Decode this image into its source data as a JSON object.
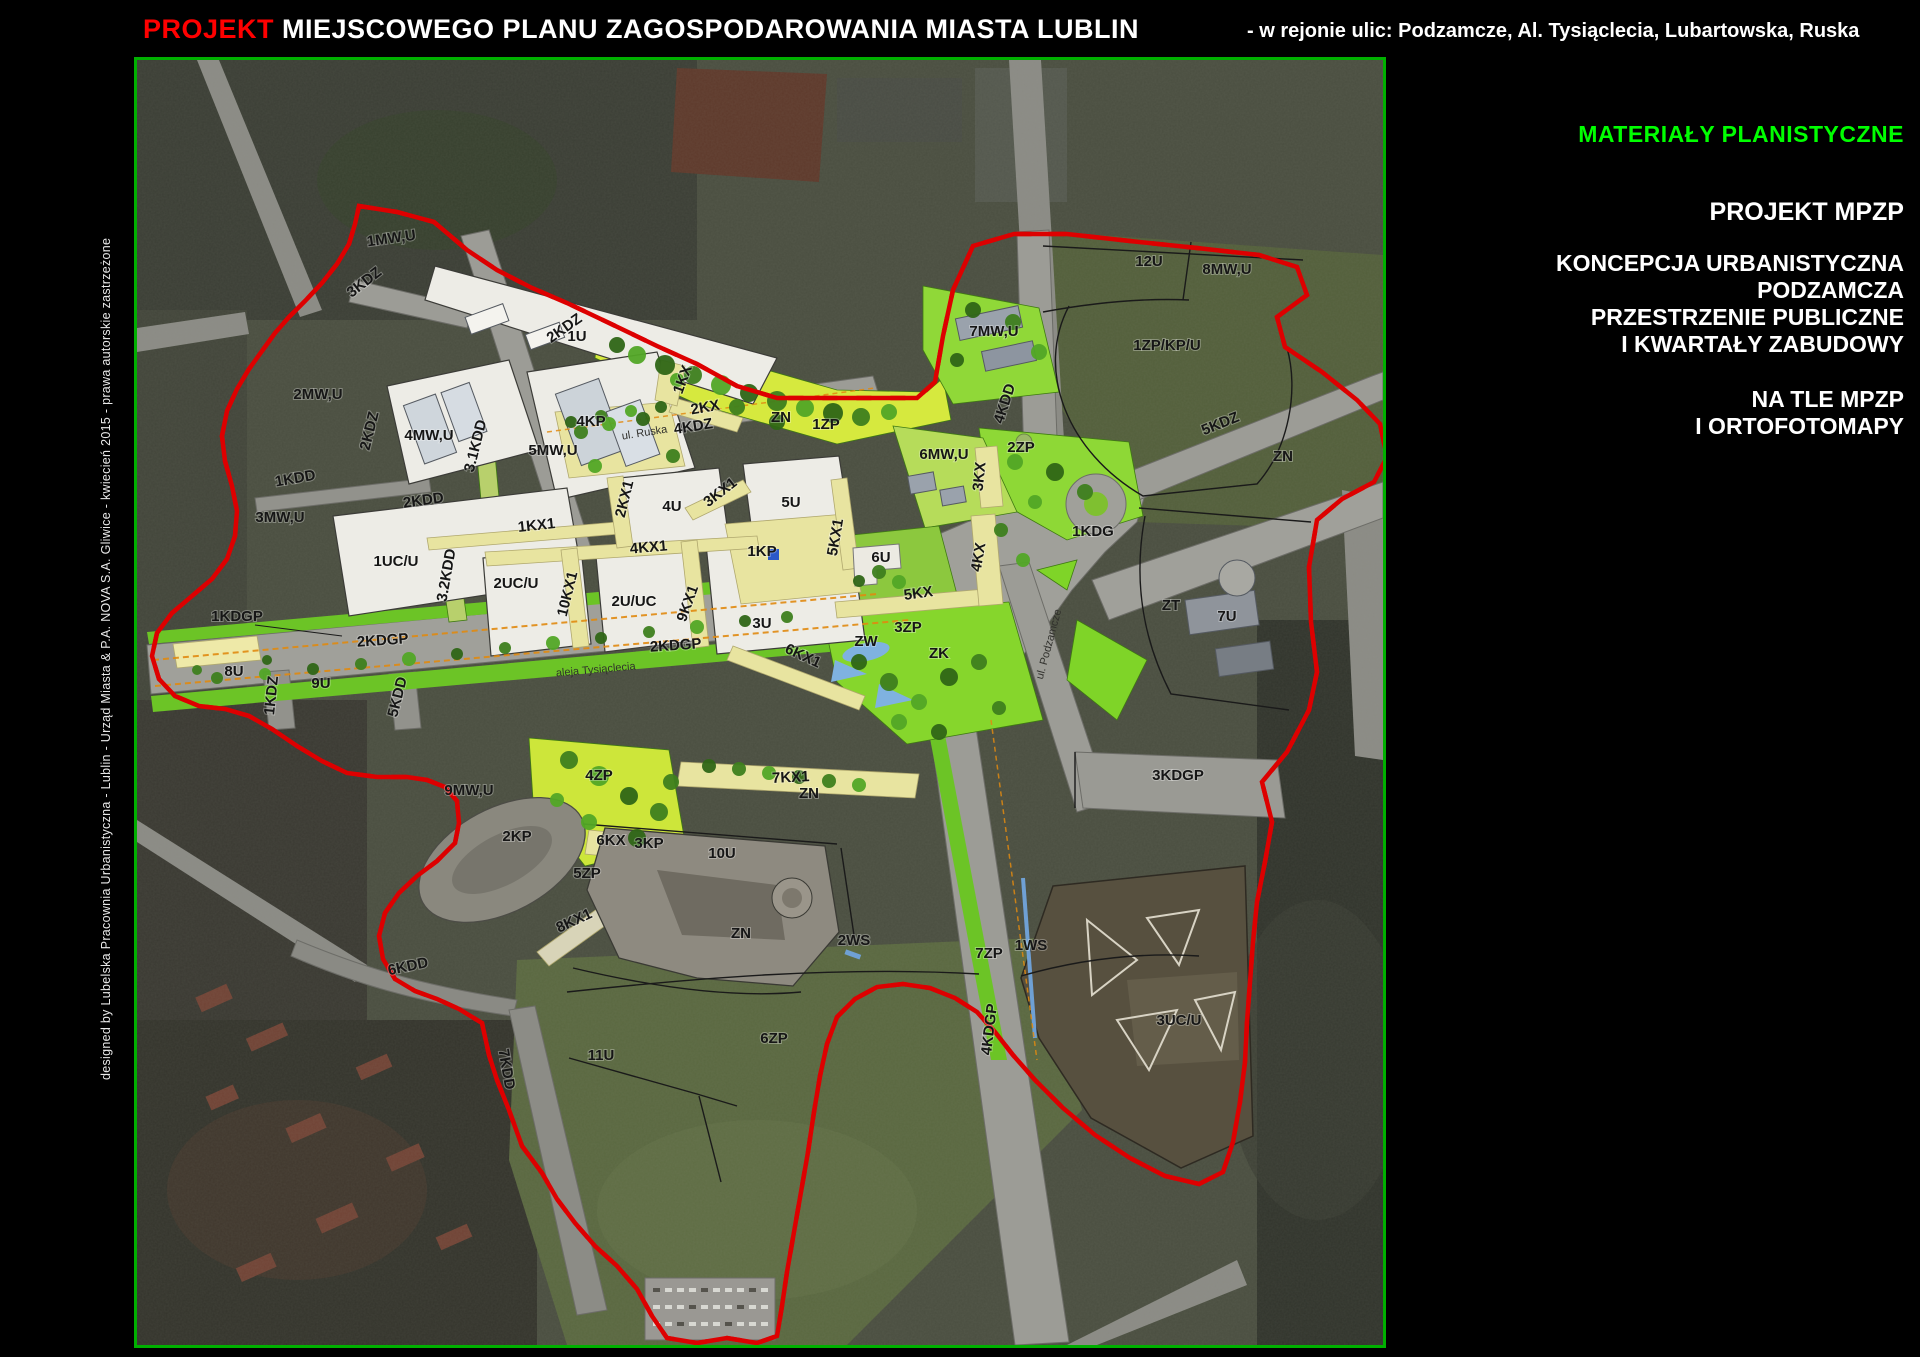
{
  "header": {
    "projekt": "PROJEKT",
    "title": " MIEJSCOWEGO PLANU ZAGOSPODAROWANIA MIASTA LUBLIN",
    "subtitle": "- w rejonie ulic: Podzamcze, Al. Tysiąclecia, Lubartowska, Ruska"
  },
  "credit": "designed by Lubelska Pracownia Urbanistyczna - Lublin - Urząd Miasta & P.A. NOVA S.A. Gliwice - kwiecień 2015 - prawa autorskie zastrzeżone",
  "panel": {
    "heading": "MATERIAŁY PLANISTYCZNE",
    "line1": "PROJEKT MPZP",
    "line2": "KONCEPCJA URBANISTYCZNA",
    "line3": "PODZAMCZA",
    "line4": "PRZESTRZENIE PUBLICZNE",
    "line5": "I KWARTAŁY ZABUDOWY",
    "line6": "NA TLE MPZP",
    "line7": "I ORTOFOTOMAPY"
  },
  "colors": {
    "projekt_red": "#ff0000",
    "materials_green": "#00ff00",
    "frame_green": "#00b000",
    "boundary_red": "#dd0000",
    "plan_yellow": "#e8e4a0",
    "plan_green": "#7fd428"
  },
  "map": {
    "labels": [
      {
        "t": "1MW,U",
        "x": 255,
        "y": 183,
        "r": -8
      },
      {
        "t": "3KDZ",
        "x": 230,
        "y": 226,
        "r": -38
      },
      {
        "t": "2MW,U",
        "x": 181,
        "y": 339
      },
      {
        "t": "1KDD",
        "x": 159,
        "y": 423,
        "r": -10
      },
      {
        "t": "3MW,U",
        "x": 143,
        "y": 462
      },
      {
        "t": "4MW,U",
        "x": 292,
        "y": 380
      },
      {
        "t": "2KDZ",
        "x": 237,
        "y": 372,
        "r": -76
      },
      {
        "t": "2KDZ",
        "x": 430,
        "y": 272,
        "r": -35
      },
      {
        "t": "3.1KDD",
        "x": 343,
        "y": 387,
        "r": -76
      },
      {
        "t": "5MW,U",
        "x": 416,
        "y": 395
      },
      {
        "t": "2KDD",
        "x": 287,
        "y": 445,
        "r": -8
      },
      {
        "t": "1UC/U",
        "x": 259,
        "y": 506
      },
      {
        "t": "3.2KDD",
        "x": 314,
        "y": 516,
        "r": -80
      },
      {
        "t": "1KDGP",
        "x": 100,
        "y": 561
      },
      {
        "t": "2KDGP",
        "x": 246,
        "y": 585,
        "r": -4
      },
      {
        "t": "8U",
        "x": 97,
        "y": 616
      },
      {
        "t": "9U",
        "x": 184,
        "y": 628
      },
      {
        "t": "1KDZ",
        "x": 139,
        "y": 636,
        "r": -84
      },
      {
        "t": "5KDD",
        "x": 265,
        "y": 638,
        "r": -76
      },
      {
        "t": "1U",
        "x": 440,
        "y": 281
      },
      {
        "t": "1KX",
        "x": 550,
        "y": 321,
        "r": -70
      },
      {
        "t": "2KX",
        "x": 569,
        "y": 352,
        "r": -10
      },
      {
        "t": "4KP",
        "x": 454,
        "y": 366
      },
      {
        "t": "ul. Ruska",
        "x": 508,
        "y": 376,
        "r": -9,
        "st": 1
      },
      {
        "t": "4KDZ",
        "x": 557,
        "y": 371,
        "r": -9
      },
      {
        "t": "7MW,U",
        "x": 857,
        "y": 276
      },
      {
        "t": "12U",
        "x": 1012,
        "y": 206
      },
      {
        "t": "8MW,U",
        "x": 1090,
        "y": 214
      },
      {
        "t": "1ZP/KP/U",
        "x": 1030,
        "y": 290
      },
      {
        "t": "5KDZ",
        "x": 1085,
        "y": 368,
        "r": -22
      },
      {
        "t": "1ZP",
        "x": 689,
        "y": 369
      },
      {
        "t": "ZN",
        "x": 644,
        "y": 362,
        "s": 10
      },
      {
        "t": "4KDD",
        "x": 872,
        "y": 345,
        "r": -72
      },
      {
        "t": "2ZP",
        "x": 884,
        "y": 392
      },
      {
        "t": "6MW,U",
        "x": 807,
        "y": 399
      },
      {
        "t": "3KX",
        "x": 847,
        "y": 417,
        "r": -84
      },
      {
        "t": "1KDG",
        "x": 956,
        "y": 476
      },
      {
        "t": "5KX1",
        "x": 703,
        "y": 478,
        "r": -80
      },
      {
        "t": "6U",
        "x": 744,
        "y": 502
      },
      {
        "t": "4KX",
        "x": 846,
        "y": 498,
        "r": -80
      },
      {
        "t": "5KX",
        "x": 782,
        "y": 538,
        "r": -8
      },
      {
        "t": "3ZP",
        "x": 771,
        "y": 572
      },
      {
        "t": "ZW",
        "x": 729,
        "y": 586,
        "s": 10
      },
      {
        "t": "ZK",
        "x": 802,
        "y": 598,
        "s": 10
      },
      {
        "t": "ul. Podzamcze",
        "x": 915,
        "y": 585,
        "r": -75,
        "st": 1
      },
      {
        "t": "4U",
        "x": 535,
        "y": 451
      },
      {
        "t": "5U",
        "x": 654,
        "y": 447
      },
      {
        "t": "1KX1",
        "x": 400,
        "y": 470,
        "r": -6
      },
      {
        "t": "2KX1",
        "x": 492,
        "y": 440,
        "r": -76
      },
      {
        "t": "3KX1",
        "x": 586,
        "y": 436,
        "r": -38
      },
      {
        "t": "1KP",
        "x": 625,
        "y": 496
      },
      {
        "t": "4KX1",
        "x": 512,
        "y": 492,
        "r": -5
      },
      {
        "t": "2UC/U",
        "x": 379,
        "y": 528
      },
      {
        "t": "10KX1",
        "x": 435,
        "y": 535,
        "r": -76
      },
      {
        "t": "2U/UC",
        "x": 497,
        "y": 546
      },
      {
        "t": "9KX1",
        "x": 555,
        "y": 545,
        "r": -70
      },
      {
        "t": "3U",
        "x": 625,
        "y": 568
      },
      {
        "t": "aleja Tysiąclecia",
        "x": 459,
        "y": 613,
        "r": -5,
        "st": 1
      },
      {
        "t": "6KX1",
        "x": 664,
        "y": 600,
        "r": 25
      },
      {
        "t": "2KDGP",
        "x": 539,
        "y": 590,
        "r": -4
      },
      {
        "t": "4ZP",
        "x": 462,
        "y": 720
      },
      {
        "t": "7KX1",
        "x": 654,
        "y": 722,
        "r": -3
      },
      {
        "t": "ZN",
        "x": 672,
        "y": 738,
        "s": 10
      },
      {
        "t": "9MW,U",
        "x": 332,
        "y": 735
      },
      {
        "t": "2KP",
        "x": 380,
        "y": 781
      },
      {
        "t": "6KX",
        "x": 474,
        "y": 785
      },
      {
        "t": "3KP",
        "x": 512,
        "y": 788
      },
      {
        "t": "10U",
        "x": 585,
        "y": 798
      },
      {
        "t": "5ZP",
        "x": 450,
        "y": 818
      },
      {
        "t": "8KX1",
        "x": 439,
        "y": 865,
        "r": -25
      },
      {
        "t": "6KDD",
        "x": 272,
        "y": 911,
        "r": -12
      },
      {
        "t": "ZN",
        "x": 604,
        "y": 878,
        "s": 10
      },
      {
        "t": "11U",
        "x": 464,
        "y": 1000
      },
      {
        "t": "6ZP",
        "x": 637,
        "y": 983
      },
      {
        "t": "7KDD",
        "x": 365,
        "y": 1010,
        "r": 80
      },
      {
        "t": "1WS",
        "x": 894,
        "y": 890
      },
      {
        "t": "4KDGP",
        "x": 857,
        "y": 970,
        "r": -83
      },
      {
        "t": "3KDGP",
        "x": 1041,
        "y": 720
      },
      {
        "t": "3UC/U",
        "x": 1042,
        "y": 965
      },
      {
        "t": "2WS",
        "x": 717,
        "y": 885
      },
      {
        "t": "7ZP",
        "x": 852,
        "y": 898
      },
      {
        "t": "7U",
        "x": 1090,
        "y": 561
      },
      {
        "t": "ZT",
        "x": 1034,
        "y": 550,
        "s": 10
      },
      {
        "t": "ZN",
        "x": 1146,
        "y": 401,
        "s": 10
      }
    ]
  }
}
